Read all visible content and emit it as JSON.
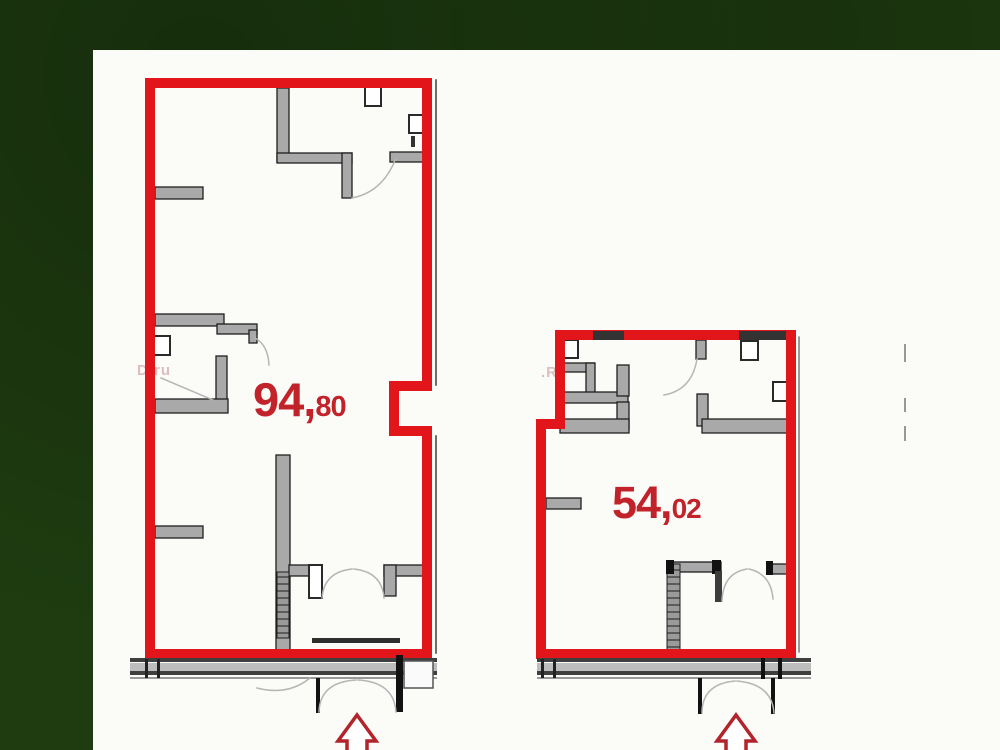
{
  "scene": {
    "background_color": "#1e3c10",
    "panel_color": "#fbfbf8"
  },
  "colors": {
    "wall_red": "#e2151a",
    "label_red": "#c2232a",
    "wall_gray": "#a9a9a9",
    "wall_dark": "#1f1f1f",
    "door_arc_gray": "#b5b5b5",
    "arrow_red": "#b2242a"
  },
  "plans": [
    {
      "name": "apartment-large",
      "area_display": "94,80",
      "label_main": "94,",
      "label_sub": "80"
    },
    {
      "name": "apartment-small",
      "area_display": "54,02",
      "label_main": "54,",
      "label_sub": "02"
    }
  ],
  "watermarks": [
    {
      "text": "D.ru"
    },
    {
      "text": ".R"
    }
  ]
}
